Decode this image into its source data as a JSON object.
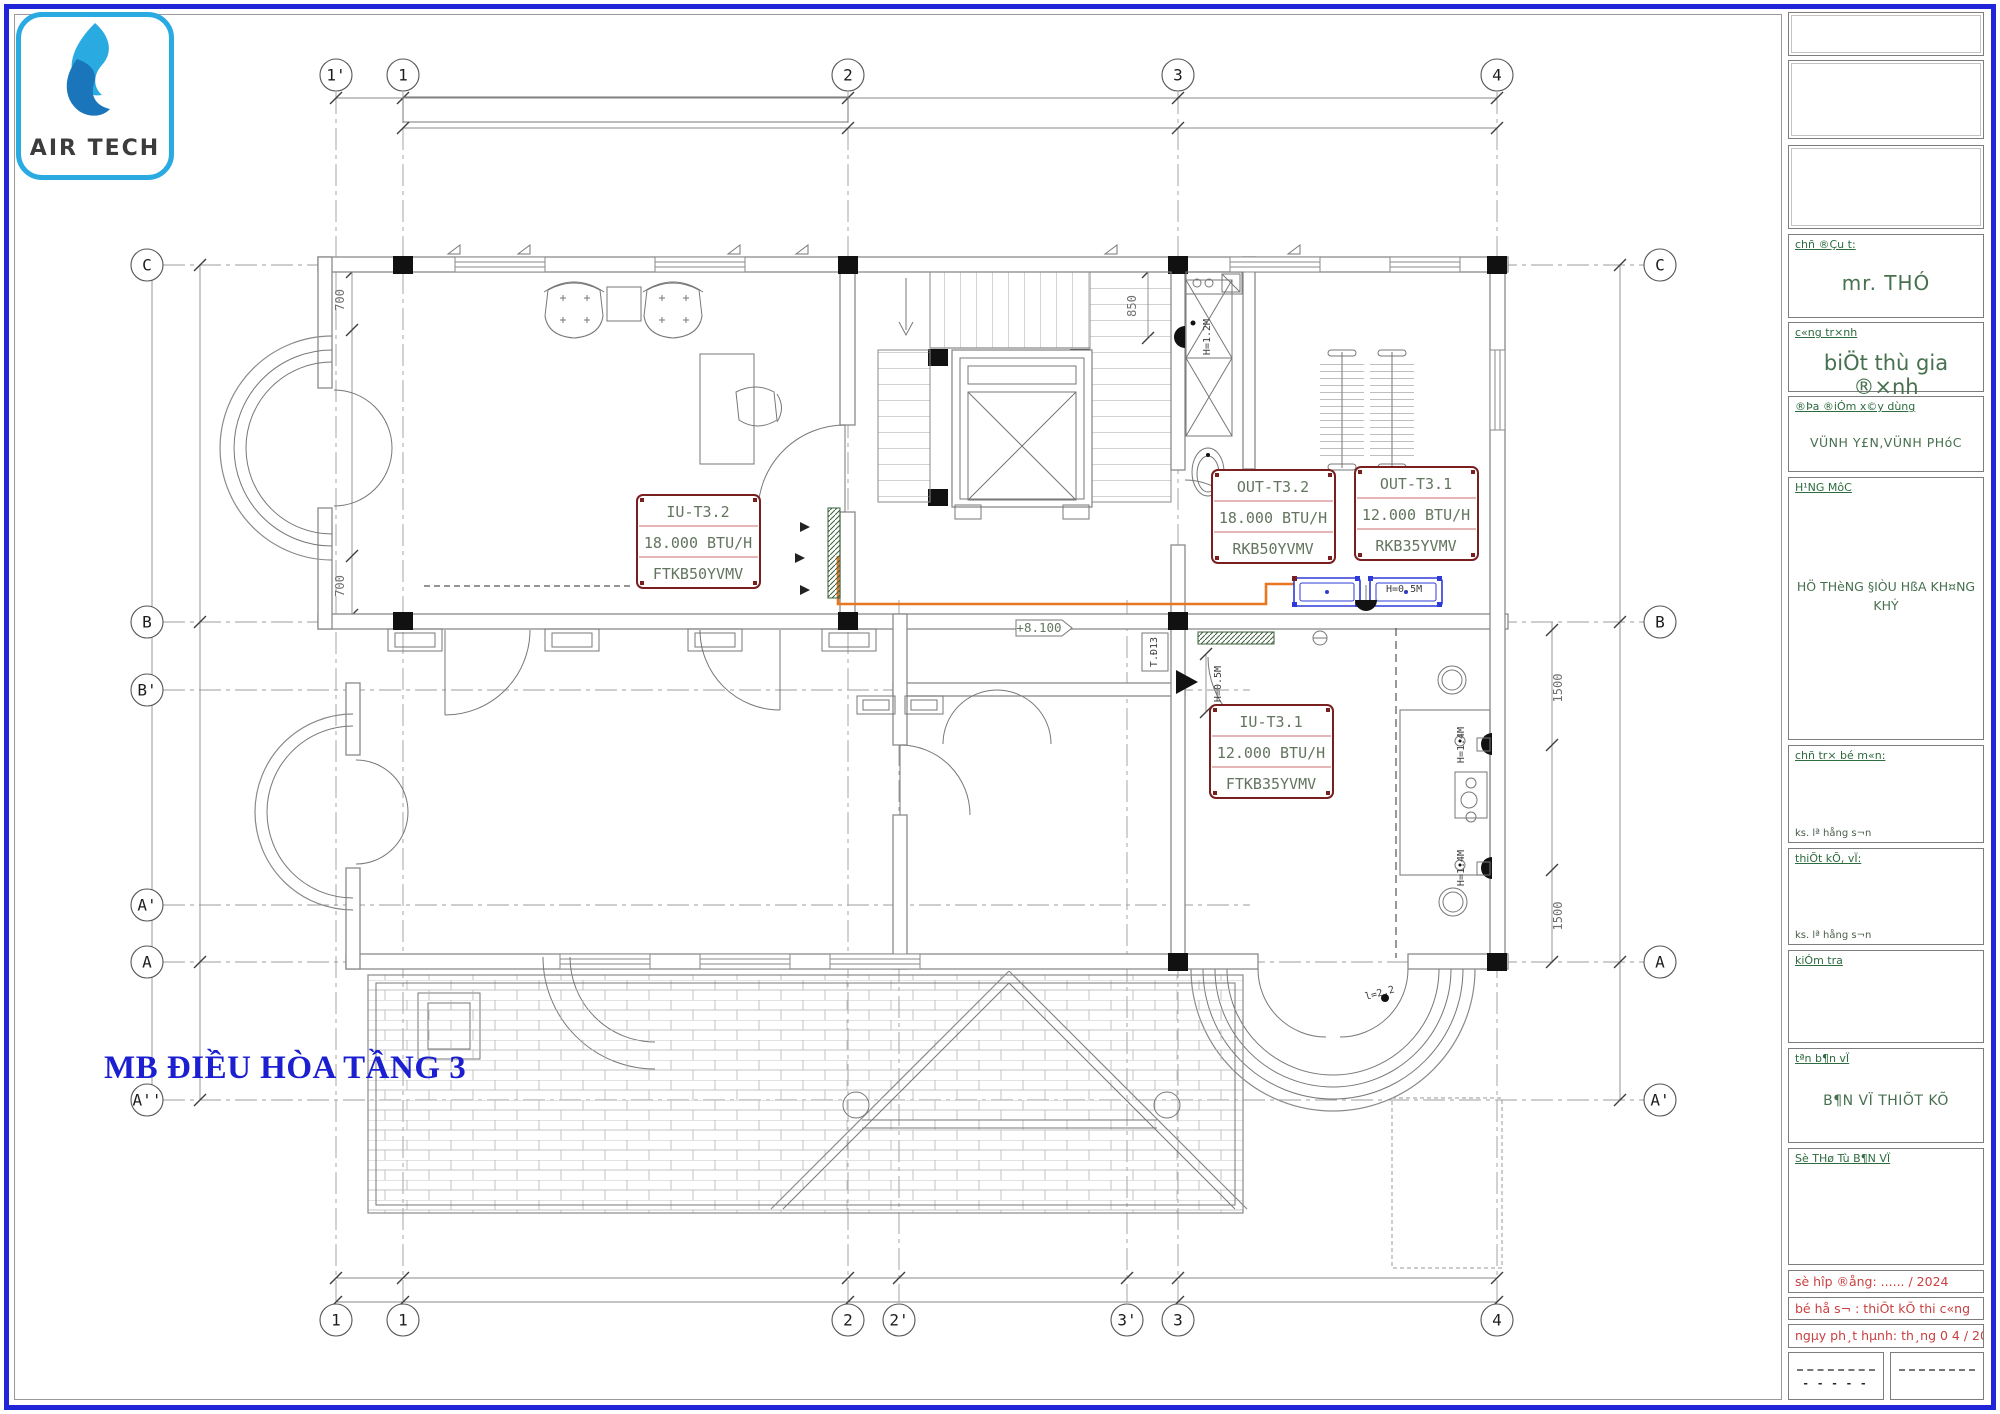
{
  "colors": {
    "frame_blue": "#2026d8",
    "logo_cyan": "#29abe2",
    "label_box_red": "#7a1f1f",
    "pipe_orange": "#e87722",
    "unit_blue": "#2e3bd6",
    "cad_text_green": "#63755f",
    "titleblock_green": "#2e6b3e",
    "titleblock_red": "#c94040",
    "title_blue": "#1b1fd0"
  },
  "logo": {
    "text": "AIR TECH"
  },
  "title": "MB ĐIỀU HÒA TẦNG 3",
  "grid": {
    "top": [
      "1'",
      "1",
      "2",
      "3",
      "4"
    ],
    "bottom": [
      "1",
      "1",
      "2",
      "2'",
      "3'",
      "3",
      "4"
    ],
    "left": [
      "C",
      "B",
      "B'",
      "A'",
      "A",
      "A''"
    ],
    "right": [
      "C",
      "B",
      "A",
      "A'"
    ]
  },
  "dims": {
    "left_top": "700",
    "left_bottom": "700",
    "stair": "850",
    "right_upper": "1500",
    "right_lower": "1500"
  },
  "marks": {
    "level": "+8.100",
    "h12": "H=1.2M",
    "h05_corridor": "H=0.5M",
    "h05_balcony": "H=0.5M",
    "h14_upper": "H=1.4M",
    "h14_lower": "H=1.4M",
    "shaft": "T.Đ13",
    "len": "l=2.2"
  },
  "units": {
    "iu_t32": {
      "id": "IU-T3.2",
      "capacity": "18.000 BTU/H",
      "model": "FTKB50YVMV"
    },
    "out_t32": {
      "id": "OUT-T3.2",
      "capacity": "18.000 BTU/H",
      "model": "RKB50YVMV"
    },
    "out_t31": {
      "id": "OUT-T3.1",
      "capacity": "12.000 BTU/H",
      "model": "RKB35YVMV"
    },
    "iu_t31": {
      "id": "IU-T3.1",
      "capacity": "12.000 BTU/H",
      "model": "FTKB35YVMV"
    }
  },
  "titleblock": {
    "owner_label": "chñ ®Çu t:",
    "owner": "mr. THÓ",
    "project_label": "c«ng tr×nh",
    "project": "biÖt thù gia ®×nh",
    "location_label": "®Þa ®iÓm x©y dùng",
    "location": "VÜNH Y£N,VÜNH PHóC",
    "category_label": "H¹NG MôC",
    "category": "HÖ THèNG §IÒU HßA KH¤NG KHÝ",
    "lead_label": "chñ tr× bé m«n:",
    "lead_name": "ks. lª hång s¬n",
    "design_label": "thiÕt kÕ, vÏ:",
    "design_name": "ks. lª hång s¬n",
    "check_label": "kiÓm tra",
    "drawing_name_label": "tªn b¶n vÏ",
    "drawing_name": "B¶N VÏ THIÕT KÕ",
    "drawing_no_label": "Sè THø Tù B¶N VÏ",
    "contract": "sè hîp ®ång: ...... / 2024",
    "dossier": "bé hå s¬ : thiÕt kÕ thi c«ng",
    "issue": "ngµy ph¸t hµnh: th¸ng 0 4 / 2024",
    "sig": "- - - - -"
  }
}
